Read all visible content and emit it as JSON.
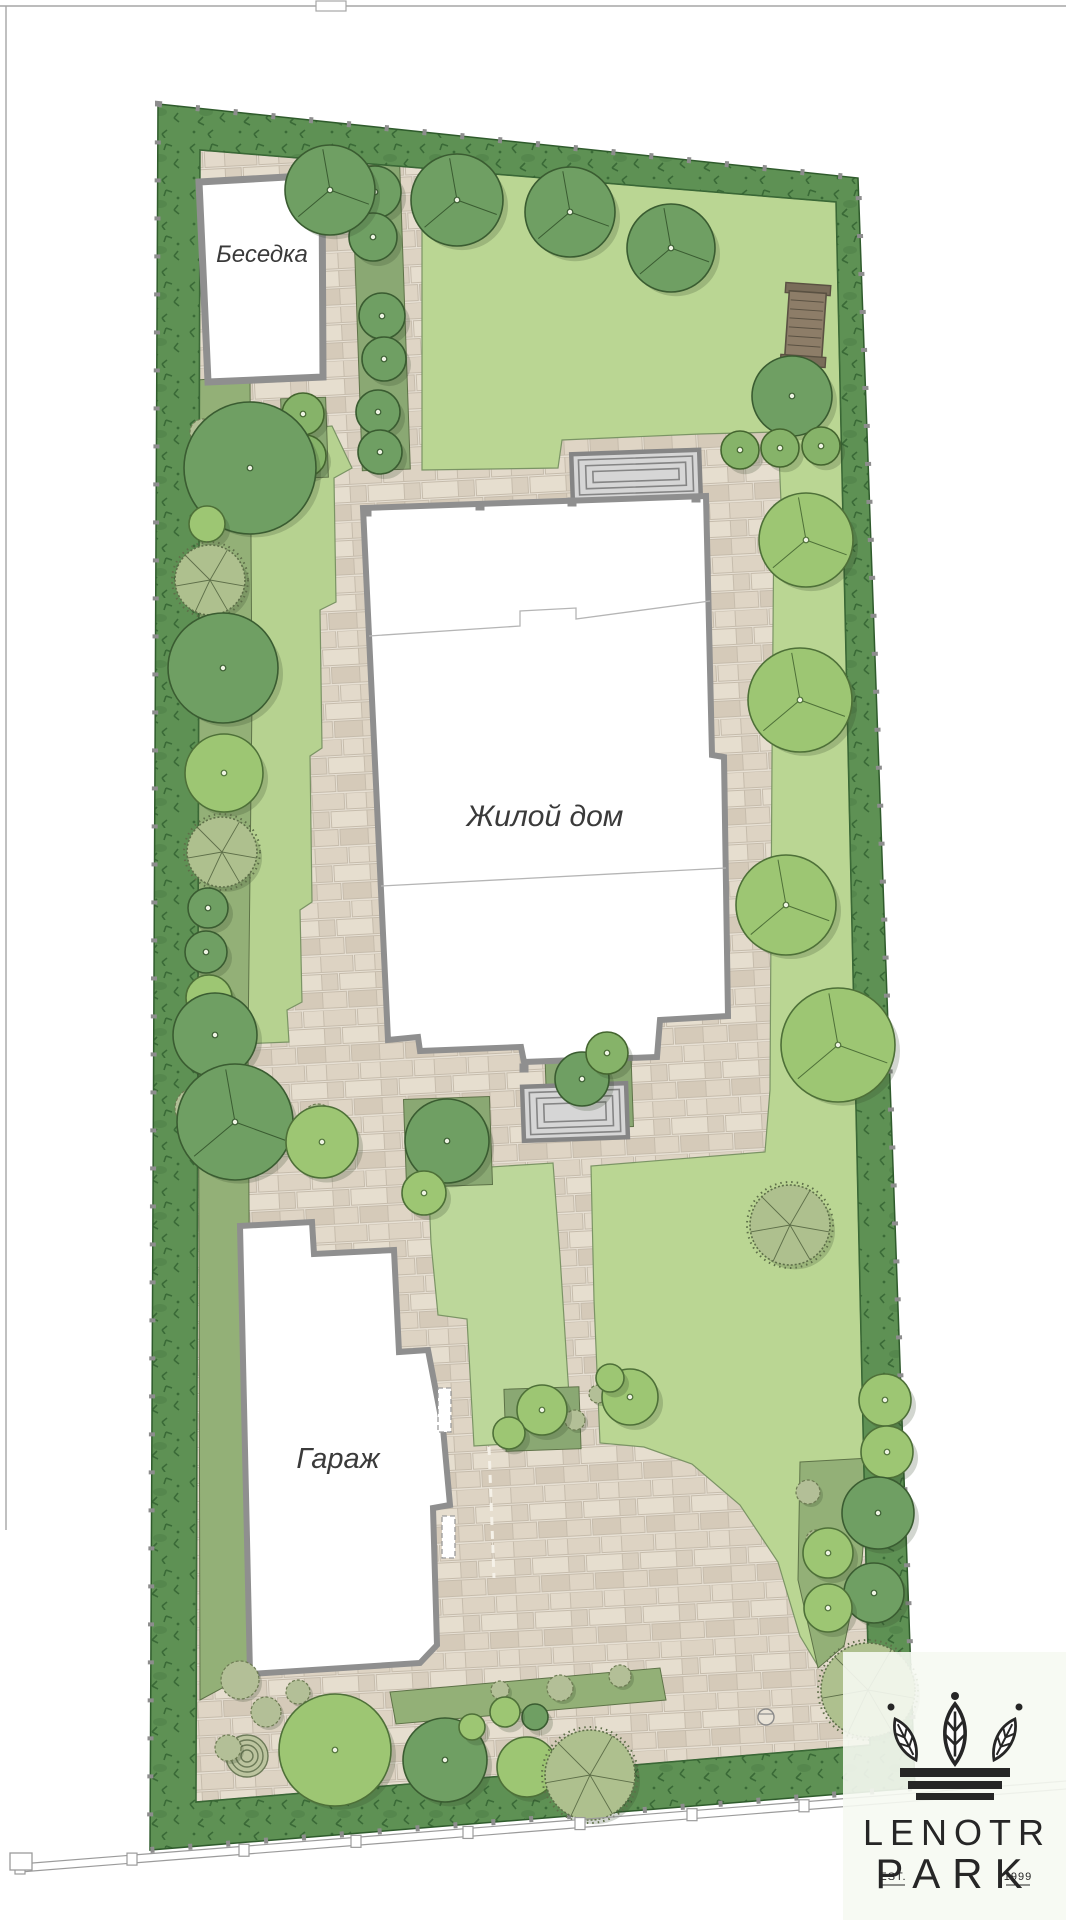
{
  "labels": {
    "gazebo": "Беседка",
    "house": "Жилой дом",
    "garage": "Гараж"
  },
  "logo": {
    "line1": "LENOTR",
    "line2": "PARK",
    "est": "EST.",
    "year": "1999"
  },
  "colors": {
    "paper": "#ffffff",
    "sheet_line": "#a6a6a6",
    "hedge_base": "#5e9154",
    "hedge_mark": "#3a6a37",
    "hedge_edge": "#2f5b2c",
    "post": "#8d8d8d",
    "lawn_main": "#bad693",
    "lawn_strip": "#b6d290",
    "lawn_mid": "#bcd79a",
    "lawn_edge": "#7b9465",
    "bed": "#93b077",
    "bed_edge": "#5e7348",
    "pit": "#8aa873",
    "wall": "#8f8f8f",
    "wall_inner": "#b5b5b5",
    "step_fill": "#d6d6d6",
    "step_line": "#858585",
    "shadow": "rgba(50,70,40,0.22)",
    "tree_dark": "#6f9f63",
    "tree_dark_edge": "#3a5c31",
    "tree_light": "#9dc673",
    "tree_light_edge": "#4e7038",
    "tree_medium": "#86b369",
    "tree_medium_edge": "#44652f",
    "tree_sage": "#aec08e",
    "tree_sage_edge": "#5e6f49",
    "dot_fill": "#eef3e3",
    "bench_fill": "#8d7d68",
    "bench_cap": "#796c59",
    "bench_line": "#5a5142",
    "fence_line": "#9b9b9b",
    "logo_ink": "#262626",
    "logo_panel": "rgba(246,250,242,0.9)"
  },
  "sheet": {
    "top_line": [
      0,
      6,
      1066,
      6
    ],
    "left_line": [
      6,
      6,
      6,
      1530
    ],
    "tab": [
      316,
      1,
      30,
      10
    ]
  },
  "plot": {
    "outer": [
      [
        158,
        104
      ],
      [
        858,
        178
      ],
      [
        915,
        1788
      ],
      [
        150,
        1850
      ]
    ],
    "inner": [
      [
        200,
        150
      ],
      [
        836,
        202
      ],
      [
        870,
        1745
      ],
      [
        196,
        1802
      ]
    ]
  },
  "lawns": [
    {
      "name": "east-lawn",
      "fill": "#bad693",
      "points": [
        [
          422,
          166
        ],
        [
          838,
          200
        ],
        [
          846,
          400
        ],
        [
          855,
          640
        ],
        [
          862,
          880
        ],
        [
          868,
          1120
        ],
        [
          874,
          1360
        ],
        [
          877,
          1458
        ],
        [
          860,
          1556
        ],
        [
          842,
          1642
        ],
        [
          818,
          1666
        ],
        [
          800,
          1636
        ],
        [
          778,
          1562
        ],
        [
          740,
          1505
        ],
        [
          692,
          1464
        ],
        [
          644,
          1447
        ],
        [
          600,
          1443
        ],
        [
          594,
          1300
        ],
        [
          591,
          1166
        ],
        [
          765,
          1152
        ],
        [
          770,
          1090
        ],
        [
          772,
          760
        ],
        [
          774,
          505
        ],
        [
          781,
          502
        ],
        [
          778,
          432
        ],
        [
          700,
          434
        ],
        [
          562,
          440
        ],
        [
          558,
          468
        ],
        [
          422,
          470
        ]
      ]
    },
    {
      "name": "west-strip-lawn",
      "fill": "#b6d290",
      "points": [
        [
          238,
          434
        ],
        [
          332,
          426
        ],
        [
          352,
          468
        ],
        [
          334,
          478
        ],
        [
          336,
          602
        ],
        [
          320,
          610
        ],
        [
          322,
          748
        ],
        [
          310,
          756
        ],
        [
          312,
          902
        ],
        [
          300,
          910
        ],
        [
          302,
          1002
        ],
        [
          287,
          1010
        ],
        [
          289,
          1042
        ],
        [
          240,
          1044
        ],
        [
          244,
          950
        ],
        [
          248,
          832
        ],
        [
          252,
          700
        ],
        [
          243,
          562
        ],
        [
          234,
          480
        ]
      ]
    },
    {
      "name": "mid-lawn",
      "fill": "#bcd79a",
      "points": [
        [
          428,
          1171
        ],
        [
          553,
          1163
        ],
        [
          560,
          1256
        ],
        [
          566,
          1350
        ],
        [
          572,
          1440
        ],
        [
          474,
          1446
        ],
        [
          467,
          1319
        ],
        [
          438,
          1315
        ],
        [
          431,
          1243
        ]
      ]
    }
  ],
  "beds": [
    {
      "name": "west-planting-bed",
      "points": [
        [
          197,
          380
        ],
        [
          250,
          376
        ],
        [
          252,
          700
        ],
        [
          248,
          1046
        ],
        [
          252,
          1672
        ],
        [
          200,
          1700
        ]
      ]
    },
    {
      "name": "east-planting-bed",
      "points": [
        [
          800,
          1462
        ],
        [
          870,
          1458
        ],
        [
          862,
          1560
        ],
        [
          844,
          1646
        ],
        [
          818,
          1668
        ],
        [
          798,
          1580
        ]
      ]
    },
    {
      "name": "south-planting-bed",
      "points": [
        [
          390,
          1692
        ],
        [
          660,
          1668
        ],
        [
          666,
          1700
        ],
        [
          396,
          1724
        ]
      ]
    }
  ],
  "pits": [
    [
      405,
      1098,
      86,
      88
    ],
    [
      546,
      1042,
      86,
      86
    ],
    [
      505,
      1388,
      75,
      62
    ],
    [
      357,
      165,
      48,
      305
    ],
    [
      282,
      398,
      45,
      80
    ]
  ],
  "buildings": {
    "gazebo": {
      "poly": [
        [
          199,
          182
        ],
        [
          322,
          175
        ],
        [
          323,
          377
        ],
        [
          208,
          382
        ]
      ],
      "label_x": 262,
      "label_y": 262,
      "font": 24
    },
    "house": {
      "poly": [
        [
          363,
          508
        ],
        [
          706,
          496
        ],
        [
          712,
          755
        ],
        [
          724,
          757
        ],
        [
          728,
          1016
        ],
        [
          660,
          1020
        ],
        [
          657,
          1057
        ],
        [
          524,
          1062
        ],
        [
          521,
          1047
        ],
        [
          420,
          1051
        ],
        [
          418,
          1037
        ],
        [
          388,
          1040
        ]
      ],
      "inner_lines": [
        [
          [
            369,
            636
          ],
          [
            520,
            626
          ],
          [
            520,
            611
          ],
          [
            576,
            608
          ],
          [
            576,
            619
          ],
          [
            710,
            601
          ]
        ],
        [
          [
            381,
            886
          ],
          [
            726,
            868
          ]
        ]
      ],
      "pillars": [
        [
          367,
          512
        ],
        [
          480,
          506
        ],
        [
          572,
          502
        ],
        [
          696,
          498
        ],
        [
          524,
          1068
        ],
        [
          620,
          1063
        ]
      ],
      "label_x": 545,
      "label_y": 826,
      "font": 30
    },
    "garage": {
      "poly": [
        [
          240,
          1226
        ],
        [
          312,
          1222
        ],
        [
          314,
          1254
        ],
        [
          394,
          1250
        ],
        [
          399,
          1352
        ],
        [
          428,
          1350
        ],
        [
          443,
          1428
        ],
        [
          450,
          1505
        ],
        [
          433,
          1508
        ],
        [
          437,
          1645
        ],
        [
          420,
          1663
        ],
        [
          250,
          1674
        ]
      ],
      "doors": [
        [
          438,
          1388,
          13,
          44
        ],
        [
          442,
          1516,
          13,
          42
        ]
      ],
      "dash_line": [
        489,
        1447,
        494,
        1578
      ],
      "label_x": 338,
      "label_y": 1468,
      "font": 29
    }
  },
  "steps": [
    {
      "x": 572,
      "y": 452,
      "w": 128,
      "h": 47,
      "rot": -2
    },
    {
      "x": 523,
      "y": 1085,
      "w": 104,
      "h": 54,
      "rot": -2
    }
  ],
  "bench": {
    "x": 787,
    "y": 292,
    "w": 37,
    "h": 66,
    "rot": 4
  },
  "spiral": {
    "x": 247,
    "y": 1756,
    "rings": [
      21,
      16,
      11,
      6
    ]
  },
  "manhole": {
    "x": 766,
    "y": 1717,
    "r": 8
  },
  "fence": {
    "x1": 20,
    "y1": 1864,
    "x2": 1066,
    "y2": 1781,
    "gap": 8,
    "posts_x": [
      20,
      132,
      244,
      356,
      468,
      580,
      692,
      804
    ],
    "end_post": [
      10,
      1853,
      22,
      17
    ]
  },
  "trees": [
    {
      "x": 375,
      "y": 192,
      "r": 26,
      "t": "dark",
      "d": 1
    },
    {
      "x": 373,
      "y": 237,
      "r": 24,
      "t": "dark",
      "d": 1
    },
    {
      "x": 382,
      "y": 316,
      "r": 23,
      "t": "dark",
      "d": 1
    },
    {
      "x": 384,
      "y": 359,
      "r": 22,
      "t": "dark",
      "d": 1
    },
    {
      "x": 378,
      "y": 412,
      "r": 22,
      "t": "dark",
      "d": 1
    },
    {
      "x": 380,
      "y": 452,
      "r": 22,
      "t": "dark",
      "d": 1
    },
    {
      "x": 303,
      "y": 414,
      "r": 21,
      "t": "medium",
      "d": 1
    },
    {
      "x": 305,
      "y": 456,
      "r": 21,
      "t": "medium",
      "d": 1
    },
    {
      "x": 250,
      "y": 468,
      "r": 66,
      "t": "dark",
      "d": 1
    },
    {
      "x": 330,
      "y": 190,
      "r": 45,
      "t": "dark",
      "d": 1,
      "b": 1
    },
    {
      "x": 457,
      "y": 200,
      "r": 46,
      "t": "dark",
      "d": 1,
      "b": 1
    },
    {
      "x": 570,
      "y": 212,
      "r": 45,
      "t": "dark",
      "d": 1,
      "b": 1
    },
    {
      "x": 671,
      "y": 248,
      "r": 44,
      "t": "dark",
      "d": 1,
      "b": 1
    },
    {
      "x": 792,
      "y": 396,
      "r": 40,
      "t": "dark",
      "d": 1
    },
    {
      "x": 740,
      "y": 450,
      "r": 19,
      "t": "medium",
      "d": 1
    },
    {
      "x": 780,
      "y": 448,
      "r": 19,
      "t": "medium",
      "d": 1
    },
    {
      "x": 821,
      "y": 446,
      "r": 19,
      "t": "medium",
      "d": 1
    },
    {
      "x": 806,
      "y": 540,
      "r": 47,
      "t": "light",
      "d": 1,
      "b": 1
    },
    {
      "x": 800,
      "y": 700,
      "r": 52,
      "t": "light",
      "d": 1,
      "b": 1
    },
    {
      "x": 786,
      "y": 905,
      "r": 50,
      "t": "light",
      "d": 1,
      "b": 1
    },
    {
      "x": 838,
      "y": 1045,
      "r": 57,
      "t": "light",
      "d": 1,
      "b": 1
    },
    {
      "x": 790,
      "y": 1225,
      "r": 40,
      "t": "sage"
    },
    {
      "x": 885,
      "y": 1400,
      "r": 26,
      "t": "light",
      "d": 1
    },
    {
      "x": 887,
      "y": 1452,
      "r": 26,
      "t": "light",
      "d": 1
    },
    {
      "x": 878,
      "y": 1513,
      "r": 36,
      "t": "dark",
      "d": 1
    },
    {
      "x": 828,
      "y": 1553,
      "r": 25,
      "t": "light",
      "d": 1
    },
    {
      "x": 874,
      "y": 1593,
      "r": 30,
      "t": "dark",
      "d": 1
    },
    {
      "x": 828,
      "y": 1608,
      "r": 24,
      "t": "light",
      "d": 1
    },
    {
      "x": 868,
      "y": 1690,
      "r": 47,
      "t": "sage"
    },
    {
      "x": 207,
      "y": 524,
      "r": 18,
      "t": "light"
    },
    {
      "x": 210,
      "y": 580,
      "r": 35,
      "t": "sage"
    },
    {
      "x": 223,
      "y": 668,
      "r": 55,
      "t": "dark",
      "d": 1
    },
    {
      "x": 224,
      "y": 773,
      "r": 39,
      "t": "light",
      "d": 1
    },
    {
      "x": 222,
      "y": 852,
      "r": 35,
      "t": "sage"
    },
    {
      "x": 208,
      "y": 908,
      "r": 20,
      "t": "dark",
      "d": 1
    },
    {
      "x": 206,
      "y": 952,
      "r": 21,
      "t": "dark",
      "d": 1
    },
    {
      "x": 209,
      "y": 998,
      "r": 23,
      "t": "light"
    },
    {
      "x": 215,
      "y": 1035,
      "r": 42,
      "t": "dark",
      "d": 1
    },
    {
      "x": 235,
      "y": 1122,
      "r": 58,
      "t": "dark",
      "d": 1,
      "b": 1
    },
    {
      "x": 322,
      "y": 1142,
      "r": 36,
      "t": "light",
      "d": 1
    },
    {
      "x": 447,
      "y": 1141,
      "r": 42,
      "t": "dark",
      "d": 1
    },
    {
      "x": 582,
      "y": 1079,
      "r": 27,
      "t": "dark",
      "d": 1
    },
    {
      "x": 607,
      "y": 1053,
      "r": 21,
      "t": "medium",
      "d": 1
    },
    {
      "x": 424,
      "y": 1193,
      "r": 22,
      "t": "light",
      "d": 1
    },
    {
      "x": 542,
      "y": 1410,
      "r": 25,
      "t": "light",
      "d": 1
    },
    {
      "x": 509,
      "y": 1433,
      "r": 16,
      "t": "light"
    },
    {
      "x": 630,
      "y": 1397,
      "r": 28,
      "t": "light",
      "d": 1
    },
    {
      "x": 610,
      "y": 1378,
      "r": 14,
      "t": "light"
    },
    {
      "x": 335,
      "y": 1750,
      "r": 56,
      "t": "light",
      "d": 1
    },
    {
      "x": 445,
      "y": 1760,
      "r": 42,
      "t": "dark",
      "d": 1
    },
    {
      "x": 527,
      "y": 1767,
      "r": 30,
      "t": "light"
    },
    {
      "x": 590,
      "y": 1775,
      "r": 45,
      "t": "sage"
    },
    {
      "x": 535,
      "y": 1717,
      "r": 13,
      "t": "dark"
    },
    {
      "x": 505,
      "y": 1712,
      "r": 15,
      "t": "light"
    },
    {
      "x": 472,
      "y": 1727,
      "r": 13,
      "t": "light"
    }
  ],
  "shrubs": [
    [
      203,
      432,
      13
    ],
    [
      215,
      452,
      10
    ],
    [
      195,
      1108,
      20
    ],
    [
      211,
      1141,
      13
    ],
    [
      318,
      1120,
      16
    ],
    [
      333,
      1156,
      12
    ],
    [
      240,
      1680,
      19
    ],
    [
      266,
      1712,
      15
    ],
    [
      228,
      1748,
      13
    ],
    [
      298,
      1692,
      12
    ],
    [
      560,
      1688,
      13
    ],
    [
      620,
      1676,
      11
    ],
    [
      808,
      1492,
      12
    ],
    [
      816,
      1540,
      10
    ],
    [
      575,
      1420,
      10
    ],
    [
      598,
      1394,
      9
    ],
    [
      463,
      1148,
      10
    ],
    [
      500,
      1690,
      9
    ]
  ],
  "logo_panel": {
    "x": 843,
    "y": 1652,
    "w": 223,
    "h": 268
  }
}
